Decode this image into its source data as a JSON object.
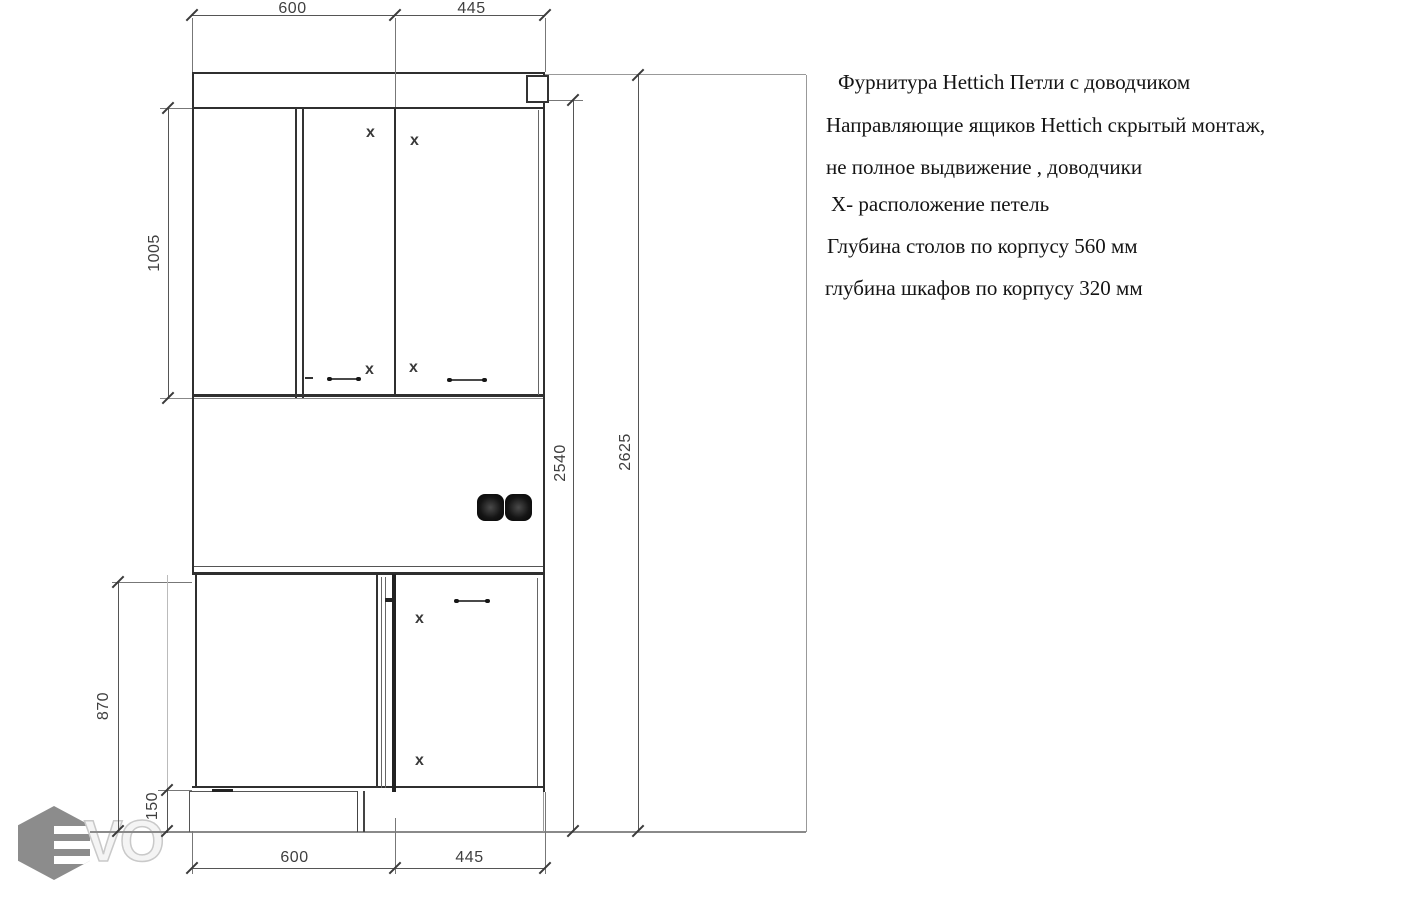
{
  "drawing": {
    "dims": {
      "top": [
        "600",
        "445"
      ],
      "bottom": [
        "600",
        "445"
      ],
      "upper_height": "1005",
      "base_height": "870",
      "plinth_height": "150",
      "inner_total_height": "2540",
      "outer_total_height": "2625"
    },
    "hinge_marker": "x",
    "notes": [
      "Фурнитура Hettich   Петли с доводчиком",
      "Направляющие ящиков Hettich скрытый монтаж,",
      "не полное выдвижение , доводчики",
      "X- расположение петель",
      "Глубина столов по корпусу 560 мм",
      "глубина шкафов по корпусу 320 мм"
    ]
  },
  "watermark": {
    "letters": "VO"
  },
  "icons": {
    "socket": "double-socket-icon",
    "hinge": "hinge-position-x"
  },
  "colors": {
    "cabinet_line": "#2f2f2f",
    "dimension_line": "#555555",
    "extension_line": "#777777",
    "floor_line": "#8a8a8a",
    "watermark_gray": "#8c8c8c",
    "text": "#141414"
  }
}
